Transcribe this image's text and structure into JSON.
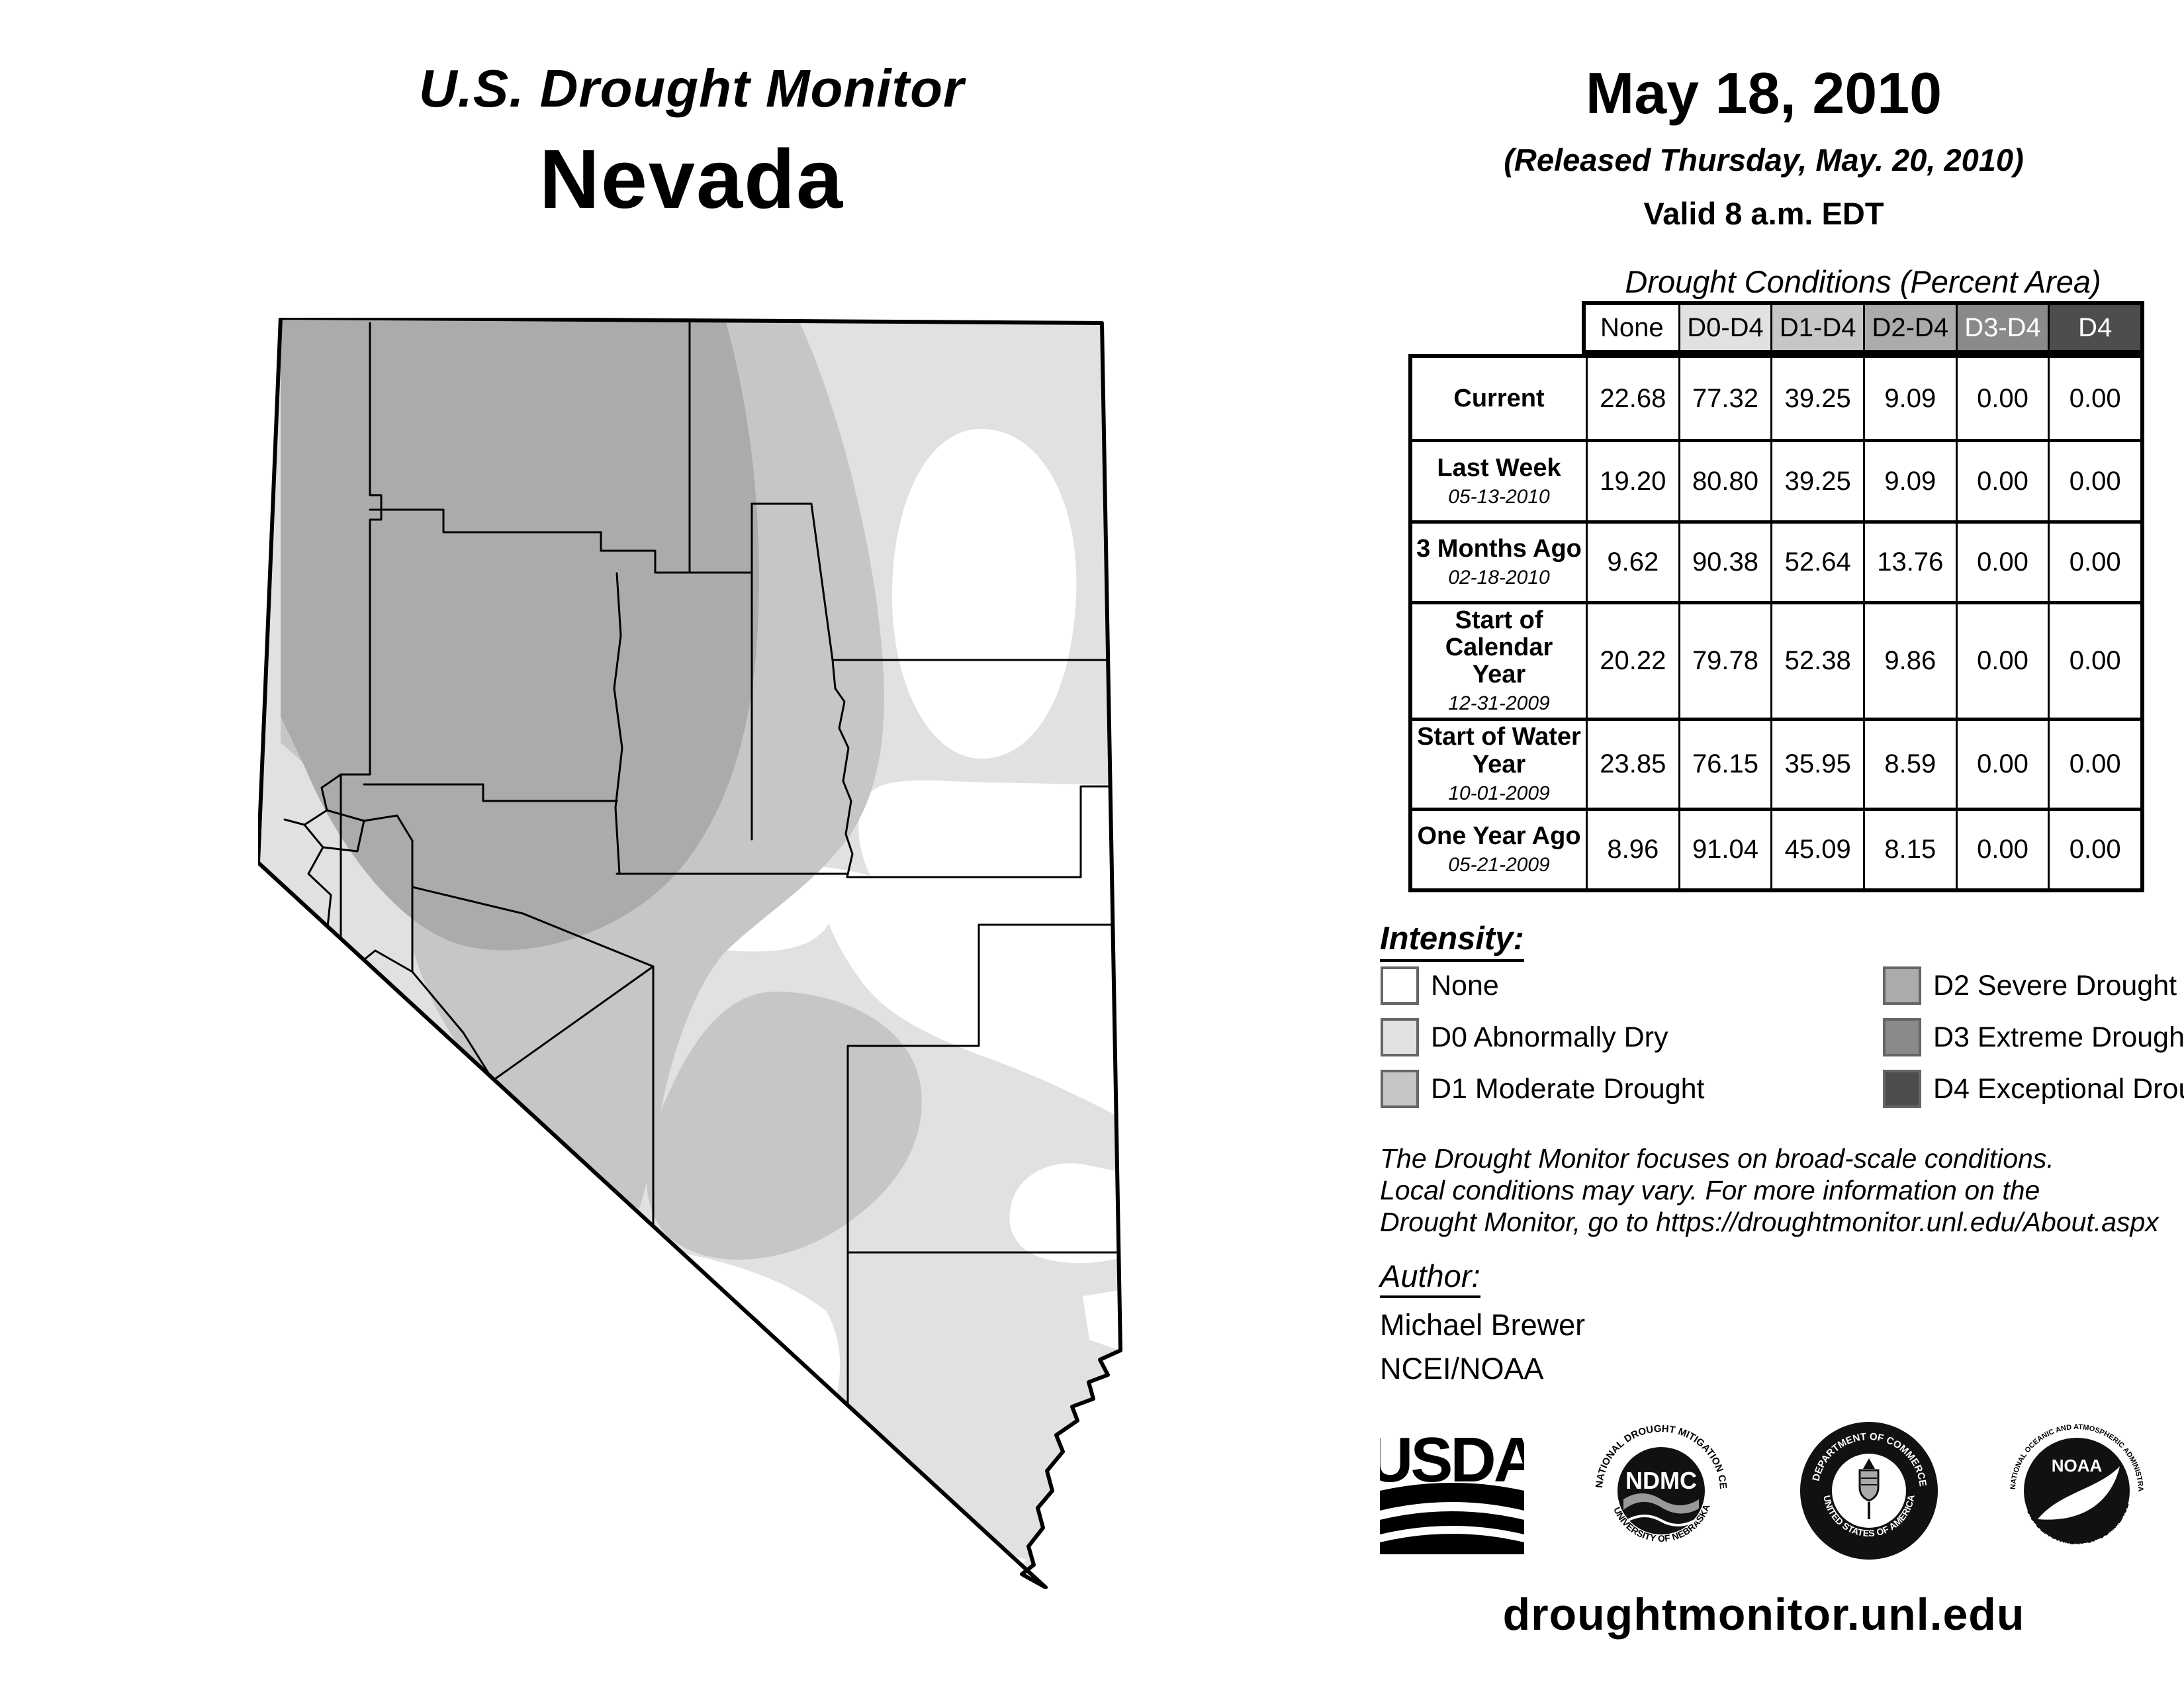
{
  "header": {
    "title": "U.S. Drought Monitor",
    "state": "Nevada",
    "date": "May 18, 2010",
    "released": "(Released Thursday, May. 20, 2010)",
    "valid": "Valid 8 a.m. EDT"
  },
  "palette": {
    "none": "#FFFFFF",
    "d0": "#E1E1E1",
    "d1": "#C6C6C6",
    "d2": "#ABABAB",
    "d3": "#8A8A8A",
    "d4": "#4D4D4D",
    "line": "#000000"
  },
  "table": {
    "title": "Drought Conditions (Percent Area)",
    "columns": [
      "None",
      "D0-D4",
      "D1-D4",
      "D2-D4",
      "D3-D4",
      "D4"
    ],
    "rows": [
      {
        "label": "Current",
        "date": "",
        "values": [
          "22.68",
          "77.32",
          "39.25",
          "9.09",
          "0.00",
          "0.00"
        ]
      },
      {
        "label": "Last Week",
        "date": "05-13-2010",
        "values": [
          "19.20",
          "80.80",
          "39.25",
          "9.09",
          "0.00",
          "0.00"
        ]
      },
      {
        "label": "3 Months Ago",
        "date": "02-18-2010",
        "values": [
          "9.62",
          "90.38",
          "52.64",
          "13.76",
          "0.00",
          "0.00"
        ]
      },
      {
        "label": "Start of Calendar Year",
        "date": "12-31-2009",
        "values": [
          "20.22",
          "79.78",
          "52.38",
          "9.86",
          "0.00",
          "0.00"
        ]
      },
      {
        "label": "Start of Water Year",
        "date": "10-01-2009",
        "values": [
          "23.85",
          "76.15",
          "35.95",
          "8.59",
          "0.00",
          "0.00"
        ]
      },
      {
        "label": "One Year Ago",
        "date": "05-21-2009",
        "values": [
          "8.96",
          "91.04",
          "45.09",
          "8.15",
          "0.00",
          "0.00"
        ]
      }
    ]
  },
  "legend": {
    "title": "Intensity:",
    "items": [
      {
        "label": "None",
        "color": "#FFFFFF"
      },
      {
        "label": "D0 Abnormally Dry",
        "color": "#E1E1E1"
      },
      {
        "label": "D1 Moderate Drought",
        "color": "#C6C6C6"
      },
      {
        "label": "D2 Severe Drought",
        "color": "#ABABAB"
      },
      {
        "label": "D3 Extreme Drought",
        "color": "#8A8A8A"
      },
      {
        "label": "D4 Exceptional Drought",
        "color": "#4D4D4D"
      }
    ]
  },
  "notes": {
    "line1": "The Drought Monitor focuses on broad-scale conditions.",
    "line2": "Local conditions may vary. For more information on the",
    "line3": "Drought Monitor, go to https://droughtmonitor.unl.edu/About.aspx"
  },
  "author": {
    "heading": "Author:",
    "name": "Michael Brewer",
    "org": "NCEI/NOAA"
  },
  "logos": {
    "usda": {
      "text": "USDA"
    },
    "ndmc": {
      "top": "NATIONAL DROUGHT MITIGATION CENTER",
      "bottom": "UNIVERSITY OF NEBRASKA",
      "center": "NDMC"
    },
    "doc": {
      "top": "DEPARTMENT OF COMMERCE",
      "bottom": "UNITED STATES OF AMERICA"
    },
    "noaa": {
      "top": "NATIONAL OCEANIC AND ATMOSPHERIC ADMINISTRATION",
      "bottom": "U.S. DEPARTMENT OF COMMERCE",
      "center": "NOAA"
    }
  },
  "footer": {
    "url": "droughtmonitor.unl.edu"
  }
}
